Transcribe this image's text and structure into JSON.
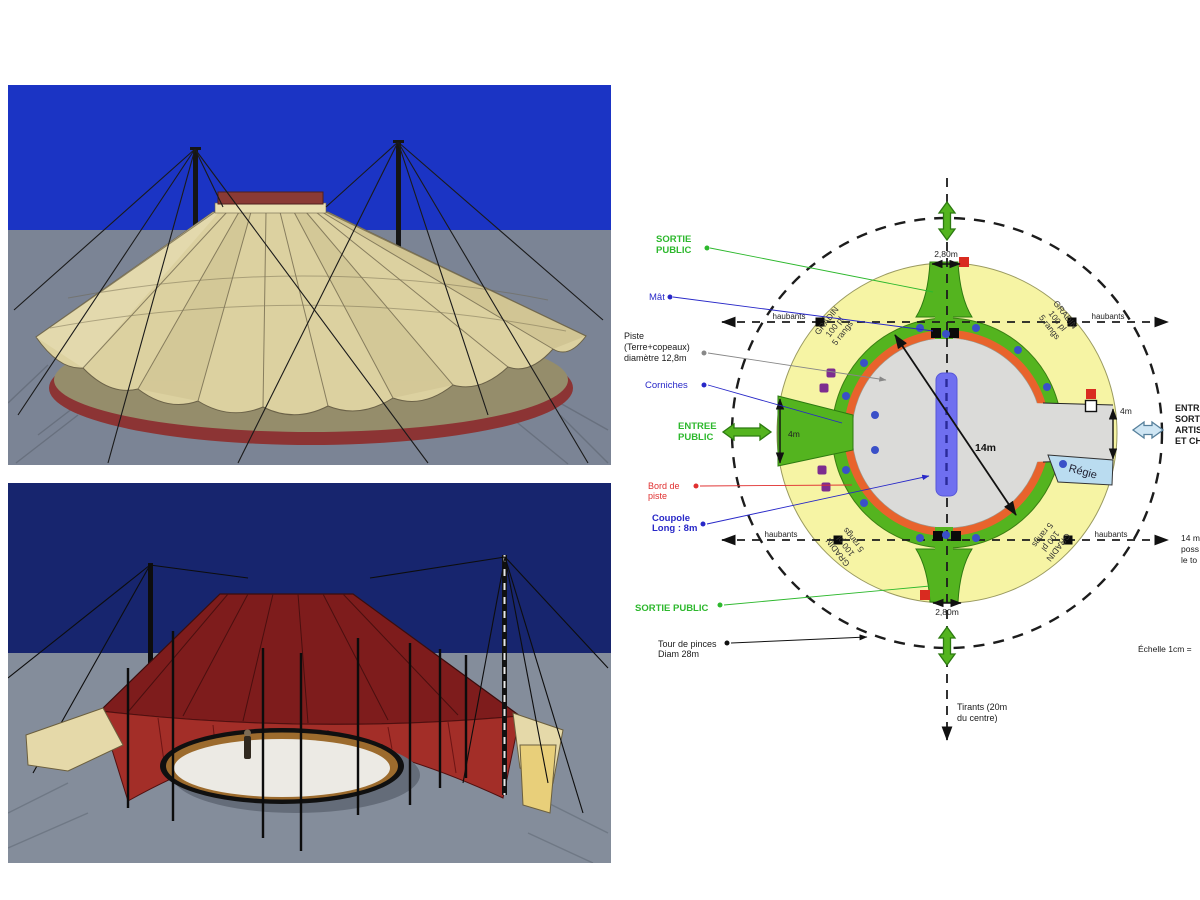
{
  "plan": {
    "labels": {
      "sortie_top_1": "SORTIE",
      "sortie_top_2": "PUBLIC",
      "mat": "Mât",
      "piste_1": "Piste",
      "piste_2": "(Terre+copeaux)",
      "piste_3": "diamètre 12,8m",
      "corniches": "Corniches",
      "entree_1": "ENTREE",
      "entree_2": "PUBLIC",
      "bord_1": "Bord de",
      "bord_2": "piste",
      "coupole_1": "Coupole",
      "coupole_2": "Long : 8m",
      "sortie_bottom": "SORTIE PUBLIC",
      "tour_1": "Tour de pinces",
      "tour_2": "Diam 28m",
      "tirants_1": "Tirants (20m",
      "tirants_2": "du centre)",
      "haubants": "haubants",
      "gradin_1": "GRADIN",
      "gradin_2": "100 pl",
      "gradin_3": "5 rangs",
      "regie": "Régie",
      "dim_280": "2,80m",
      "dim_4m": "4m",
      "dim_14m": "14m",
      "artistes_1": "ENTRÉE",
      "artistes_2": "SORTIE",
      "artistes_3": "ARTISTES",
      "artistes_4": "ET CHEVAUX",
      "note_right_1": "14 m",
      "note_right_2": "poss",
      "note_right_3": "le to",
      "echelle": "Échelle 1cm ="
    },
    "colors": {
      "gradin_yellow": "#f6f4a4",
      "ring_green": "#54b41f",
      "bord_orange": "#e8632c",
      "piste_gray": "#dbdbd9",
      "coupole_blue": "#6f6ff0",
      "regie_blue": "#badcf0",
      "corniche_dot_blue": "#3a50c8",
      "purple_square": "#7d2d8f",
      "red_square": "#d92b20",
      "label_green": "#2db82d",
      "label_blue": "#2828c8",
      "label_red": "#e03030"
    }
  }
}
